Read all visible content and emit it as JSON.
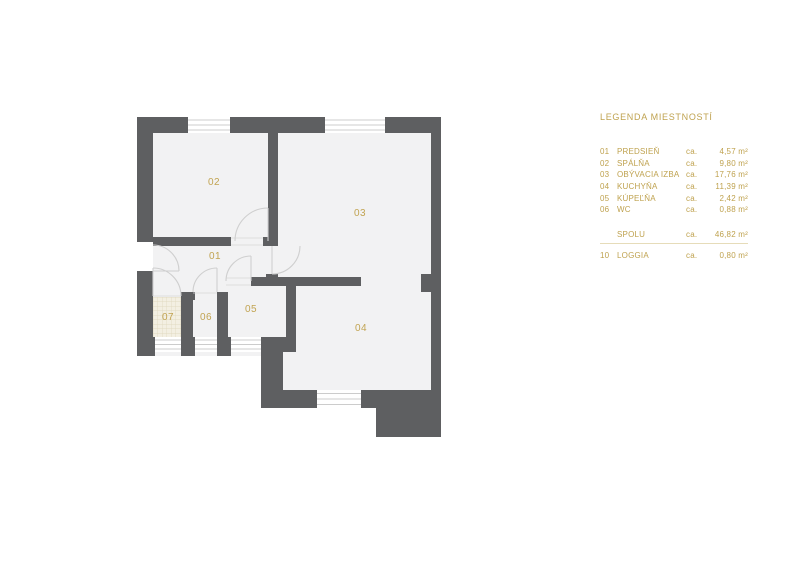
{
  "plan": {
    "labels": {
      "r01": "01",
      "r02": "02",
      "r03": "03",
      "r04": "04",
      "r05": "05",
      "r06": "06",
      "r07": "07"
    },
    "colors": {
      "wall": "#5e5f61",
      "floor": "#f2f2f3",
      "accent": "#c2a452",
      "legend_text": "#bfa24f"
    }
  },
  "legend": {
    "title": "LEGENDA MIESTNOSTÍ",
    "ca_label": "ca.",
    "rows": [
      {
        "num": "01",
        "name": "PREDSIEŇ",
        "ca": "ca.",
        "area": "4,57 m²"
      },
      {
        "num": "02",
        "name": "SPÁLŇA",
        "ca": "ca.",
        "area": "9,80 m²"
      },
      {
        "num": "03",
        "name": "OBÝVACIA IZBA",
        "ca": "ca.",
        "area": "17,76 m²"
      },
      {
        "num": "04",
        "name": "KUCHYŇA",
        "ca": "ca.",
        "area": "11,39 m²"
      },
      {
        "num": "05",
        "name": "KÚPEĽŇA",
        "ca": "ca.",
        "area": "2,42 m²"
      },
      {
        "num": "06",
        "name": "WC",
        "ca": "ca.",
        "area": "0,88 m²"
      }
    ],
    "total": {
      "num": "",
      "name": "SPOLU",
      "ca": "ca.",
      "area": "46,82 m²"
    },
    "extra": {
      "num": "10",
      "name": "LOGGIA",
      "ca": "ca.",
      "area": "0,80 m²"
    }
  }
}
